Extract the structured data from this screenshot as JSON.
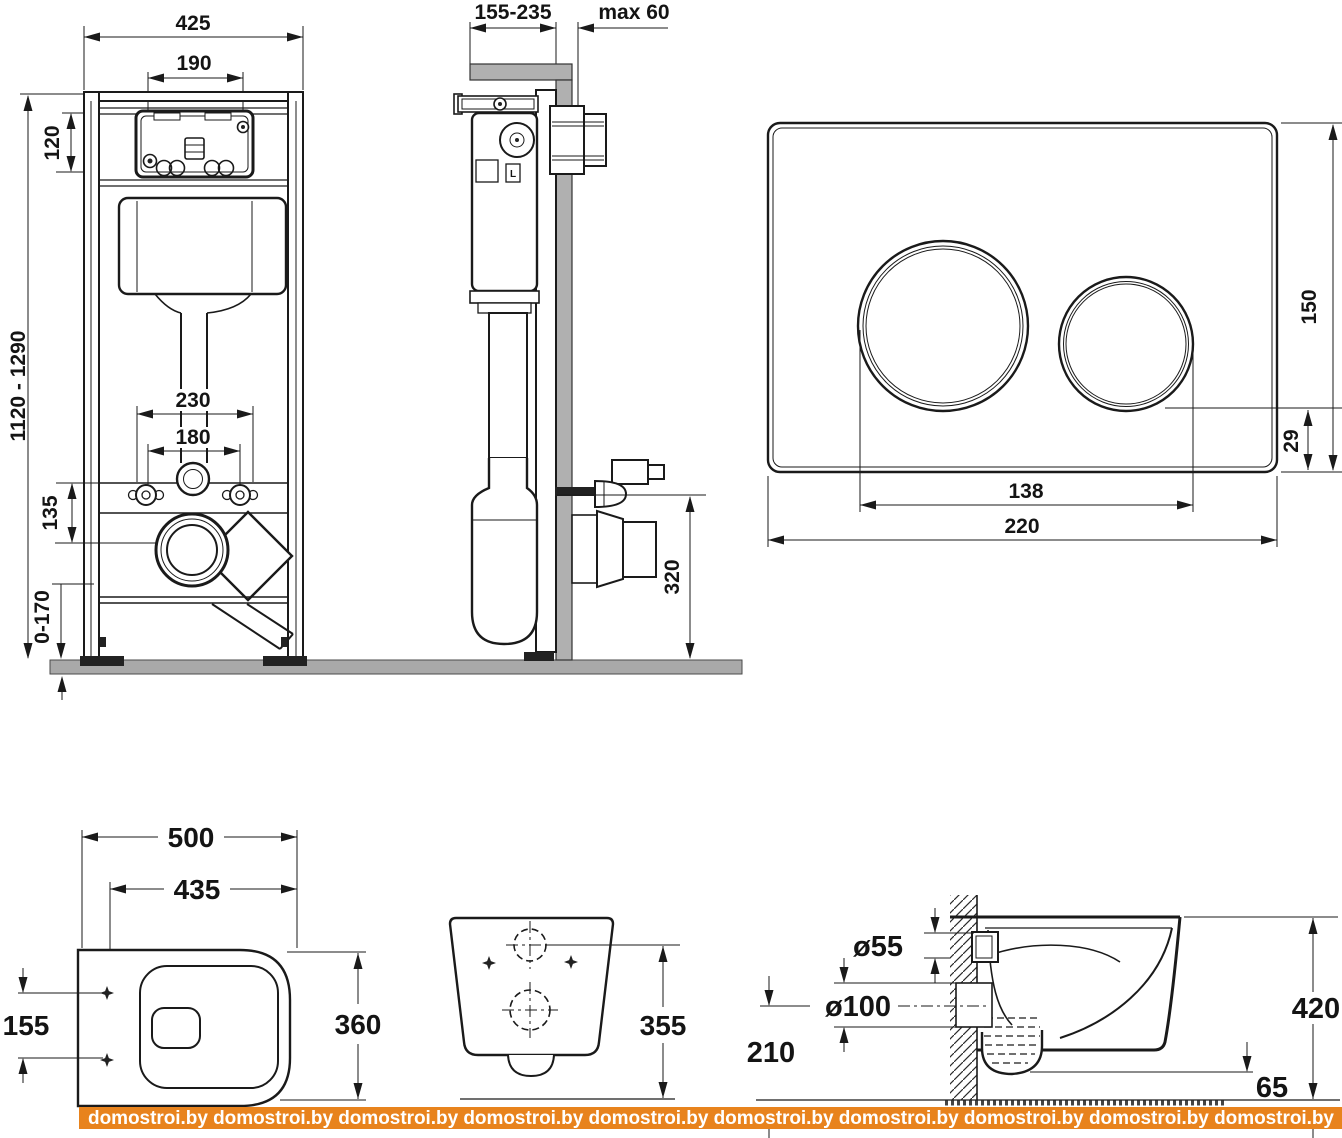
{
  "watermark": {
    "text": "domostroi.by",
    "line": "domostroi.by domostroi.by domostroi.by domostroi.by domostroi.by domostroi.by domostroi.by domostroi.by domostroi.by domostroi.by",
    "bg_color": "#e8831d",
    "text_color": "#ffffff"
  },
  "colors": {
    "line": "#1a1a1a",
    "floor_gray": "#a9a9a9",
    "wall_gray": "#b0b0b0"
  },
  "frame_front": {
    "dim_total_width": "425",
    "dim_plate_width": "190",
    "dim_box_height": "120",
    "dim_height_range": "1120 - 1290",
    "dim_bolt_span": "230",
    "dim_bolt_span_inner": "180",
    "dim_outlet_offset": "135",
    "dim_foot_adjust": "0-170"
  },
  "frame_side": {
    "dim_depth_range": "155-235",
    "dim_wall_max": "max 60",
    "dim_outlet_height": "320",
    "cistern_mark": "L"
  },
  "flush_plate": {
    "dim_height": "150",
    "dim_button_offset": "29",
    "dim_button_centers": "138",
    "dim_width": "220"
  },
  "bowl_top": {
    "dim_width": "500",
    "dim_mount_width": "435",
    "dim_mount_span": "155",
    "dim_depth": "360"
  },
  "bowl_rear": {
    "dim_height": "355"
  },
  "bowl_side": {
    "dim_inlet": "ø55",
    "dim_outlet": "ø100",
    "dim_outlet_axis": "210",
    "dim_height": "420",
    "dim_bottom_gap": "65"
  }
}
